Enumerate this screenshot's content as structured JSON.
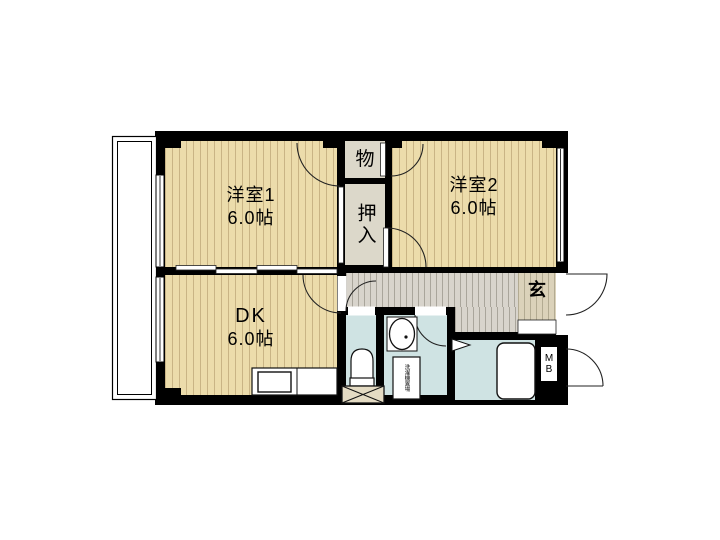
{
  "rooms": {
    "western1": {
      "label": "洋室1",
      "area": "6.0帖"
    },
    "western2": {
      "label": "洋室2",
      "area": "6.0帖"
    },
    "dining_kitchen": {
      "label": "DK",
      "area": "6.0帖"
    },
    "storage": {
      "label": "物"
    },
    "closet": {
      "label": "押入"
    },
    "entrance": {
      "label": "玄"
    },
    "meter_box": {
      "label": "MB"
    },
    "laundry": {
      "label": "洗濯機置場"
    }
  },
  "colors": {
    "wood": "#ecdcab",
    "wood_stripe": "#c9b485",
    "closet_bg": "#dcd8ca",
    "hall_bg": "#d8d4cc",
    "hall_stripe": "#a9a59b",
    "tile_bg": "#dbd2ba",
    "tile_stripe": "#b3ab92",
    "wet_bg": "#cfe3e3",
    "wall": "#000000",
    "line": "#1f1f1f",
    "hatch_bg": "#e4dbc3"
  }
}
